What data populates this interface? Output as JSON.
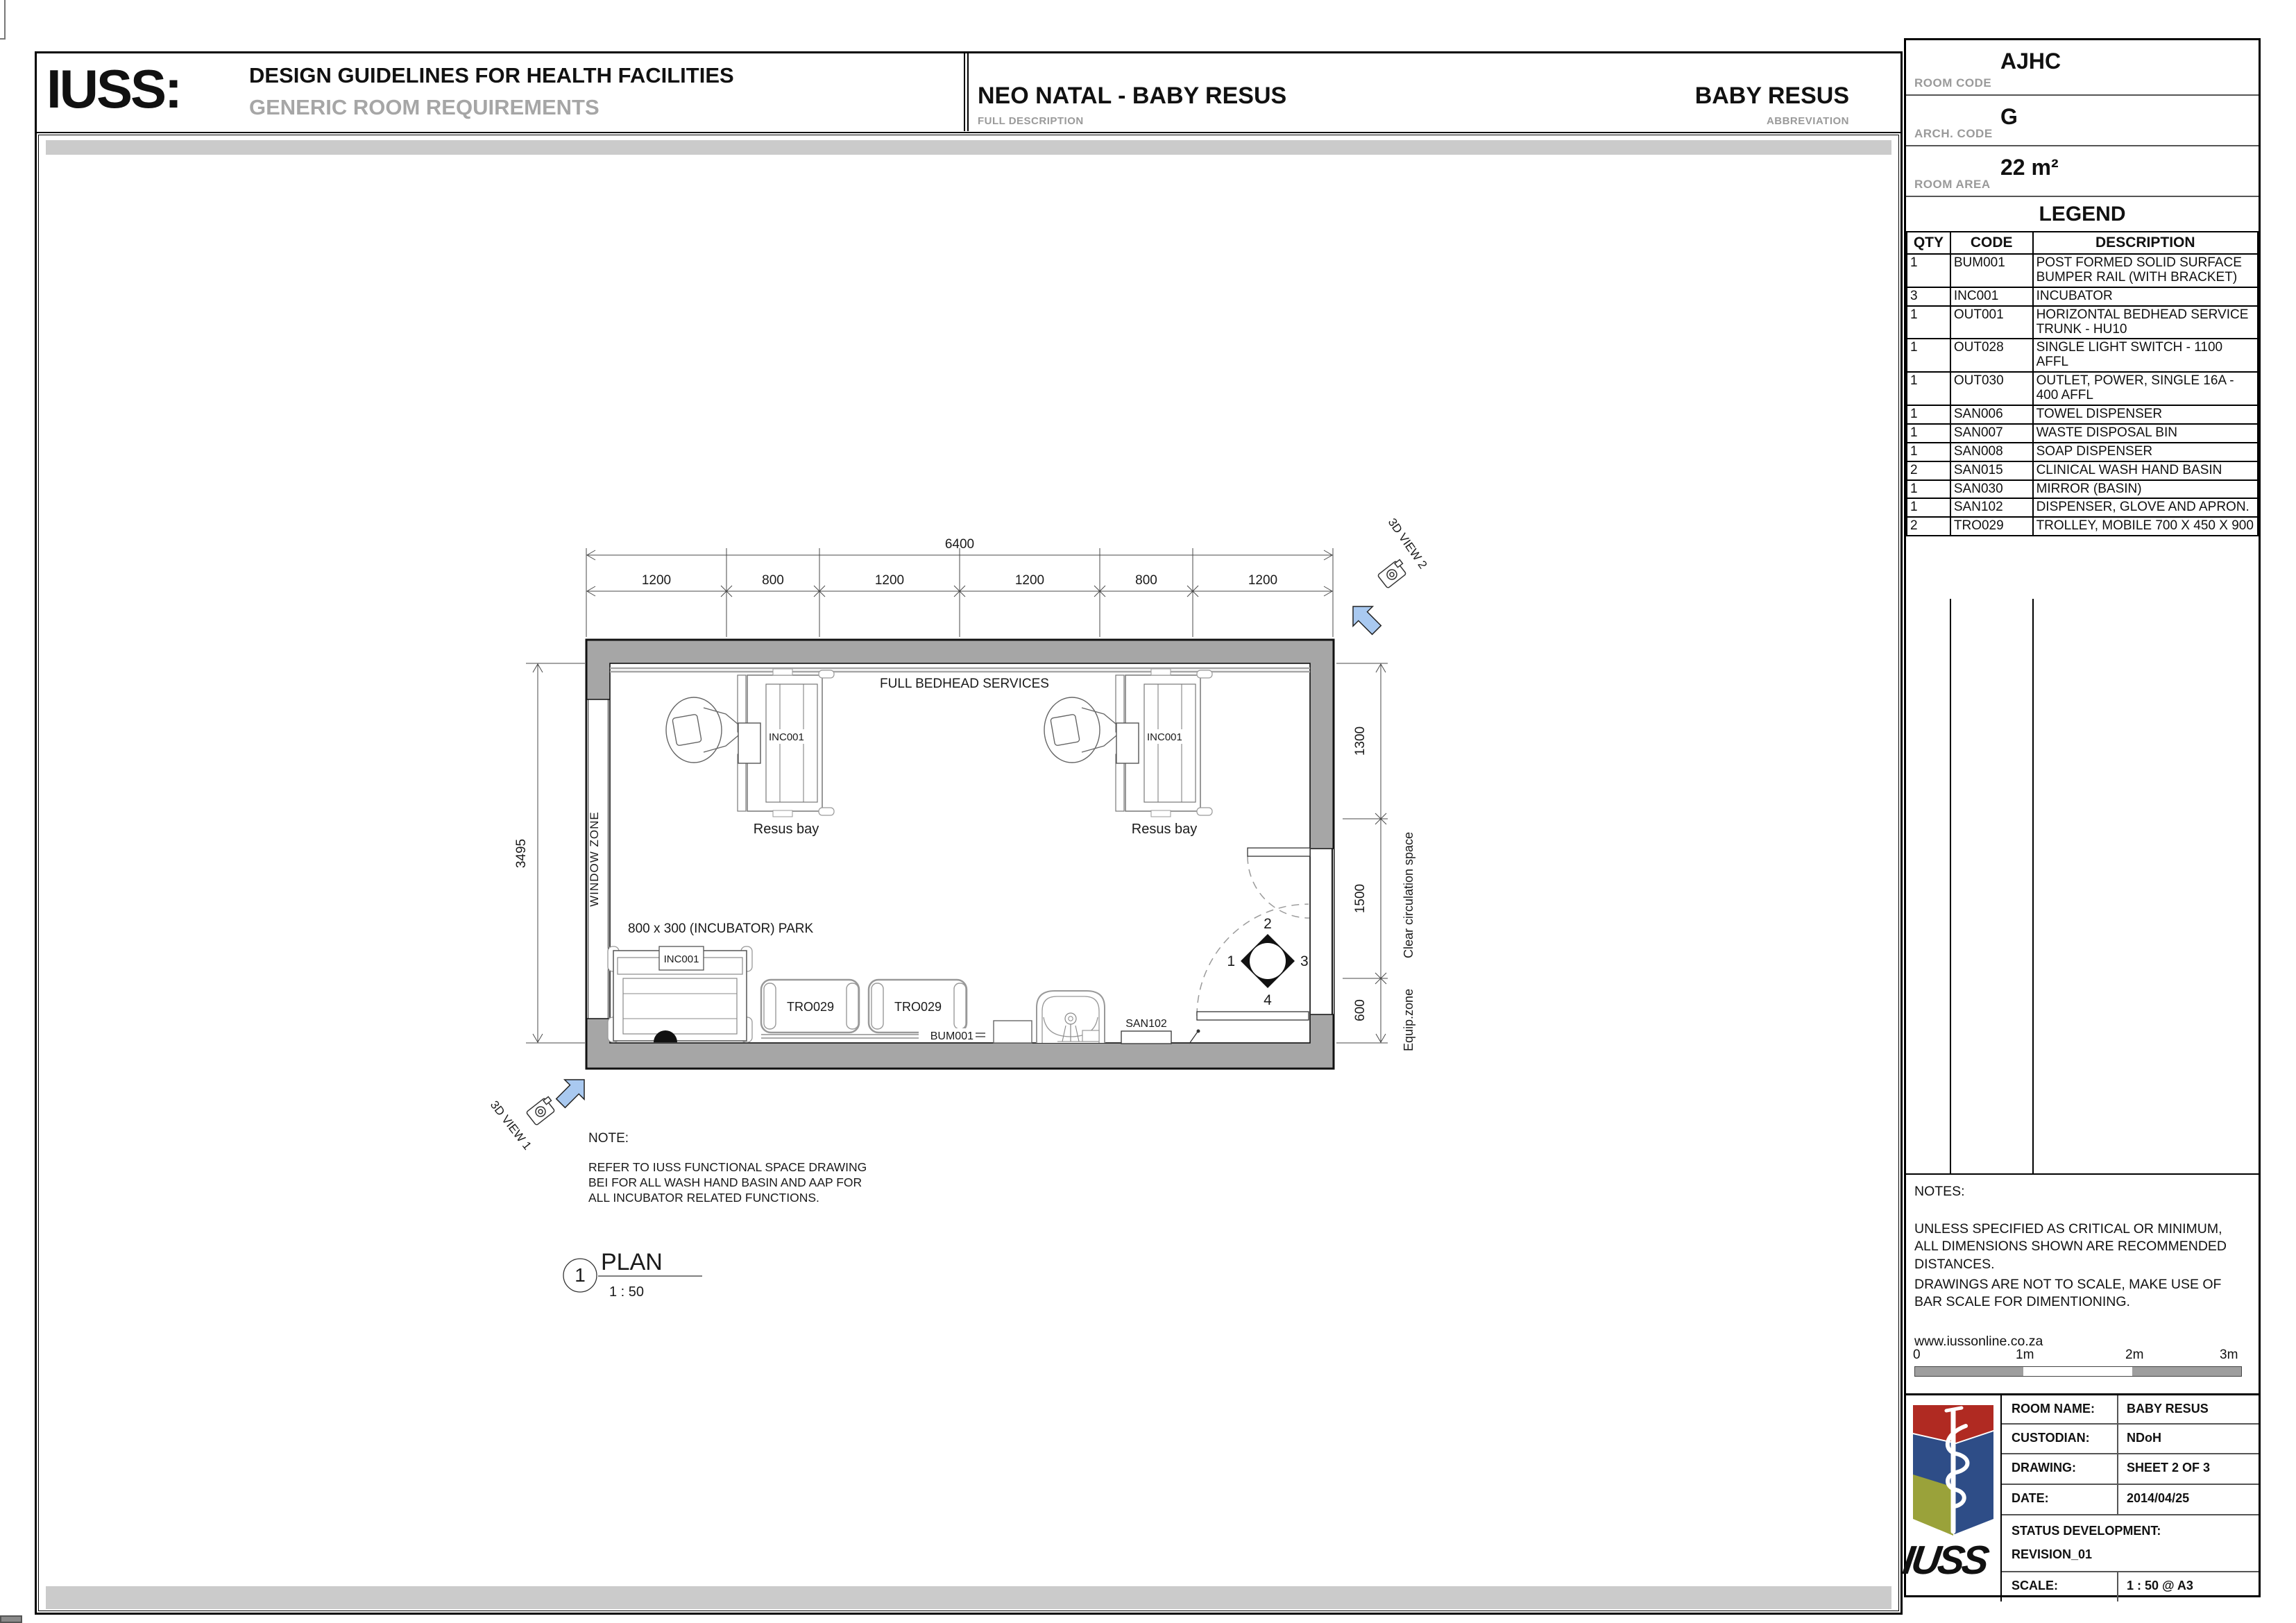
{
  "colors": {
    "wall_gray": "#a6a6a6",
    "band_gray": "#cbcbcb",
    "arrow_blue": "#a9c9f0",
    "logo_red": "#b02a22",
    "logo_blue": "#2e4d87",
    "logo_olive": "#9aa23a"
  },
  "header": {
    "brand": "IUSS:",
    "title": "DESIGN GUIDELINES FOR HEALTH FACILITIES",
    "subtitle": "GENERIC ROOM REQUIREMENTS",
    "full_description": "NEO NATAL  - BABY RESUS",
    "full_description_label": "FULL DESCRIPTION",
    "abbreviation": "BABY RESUS",
    "abbreviation_label": "ABBREVIATION"
  },
  "info": {
    "room_code_label": "ROOM CODE",
    "room_code": "AJHC",
    "arch_code_label": "ARCH. CODE",
    "arch_code": "G",
    "room_area_label": "ROOM AREA",
    "room_area": "22 m²"
  },
  "legend": {
    "title": "LEGEND",
    "col_qty": "QTY",
    "col_code": "CODE",
    "col_desc": "DESCRIPTION",
    "rows": [
      {
        "qty": "1",
        "code": "BUM001",
        "desc": "POST FORMED SOLID SURFACE BUMPER RAIL (WITH BRACKET)"
      },
      {
        "qty": "3",
        "code": "INC001",
        "desc": "INCUBATOR"
      },
      {
        "qty": "1",
        "code": "OUT001",
        "desc": "HORIZONTAL BEDHEAD SERVICE TRUNK - HU10"
      },
      {
        "qty": "1",
        "code": "OUT028",
        "desc": "SINGLE LIGHT SWITCH - 1100 AFFL"
      },
      {
        "qty": "1",
        "code": "OUT030",
        "desc": "OUTLET, POWER, SINGLE 16A - 400 AFFL"
      },
      {
        "qty": "1",
        "code": "SAN006",
        "desc": "TOWEL DISPENSER"
      },
      {
        "qty": "1",
        "code": "SAN007",
        "desc": "WASTE DISPOSAL BIN"
      },
      {
        "qty": "1",
        "code": "SAN008",
        "desc": "SOAP DISPENSER"
      },
      {
        "qty": "2",
        "code": "SAN015",
        "desc": "CLINICAL WASH HAND BASIN"
      },
      {
        "qty": "1",
        "code": "SAN030",
        "desc": "MIRROR (BASIN)"
      },
      {
        "qty": "1",
        "code": "SAN102",
        "desc": "DISPENSER, GLOVE AND APRON."
      },
      {
        "qty": "2",
        "code": "TRO029",
        "desc": "TROLLEY, MOBILE 700 X 450 X 900"
      }
    ]
  },
  "notes_panel": {
    "title": "NOTES:",
    "para1": "UNLESS SPECIFIED AS CRITICAL OR MINIMUM, ALL DIMENSIONS SHOWN ARE RECOMMENDED DISTANCES.",
    "para2": "DRAWINGS ARE NOT TO SCALE, MAKE USE OF BAR SCALE FOR DIMENTIONING.",
    "website": "www.iussonline.co.za",
    "scale_ticks": [
      "0",
      "1m",
      "2m",
      "3m"
    ]
  },
  "titleblock": {
    "logo_text": "IUSS",
    "room_name_label": "ROOM NAME:",
    "room_name": "BABY RESUS",
    "custodian_label": "CUSTODIAN:",
    "custodian": "NDoH",
    "drawing_label": "DRAWING:",
    "drawing": "SHEET 2 OF 3",
    "date_label": "DATE:",
    "date": "2014/04/25",
    "status_label": "STATUS DEVELOPMENT:",
    "status_value": "REVISION_01",
    "scale_label": "SCALE:",
    "scale_value": "1 : 50 @ A3"
  },
  "plan": {
    "dims": {
      "total_width": "6400",
      "top_segments": [
        "1200",
        "800",
        "1200",
        "1200",
        "800",
        "1200"
      ],
      "left_height": "3495",
      "right_segments": [
        "1300",
        "1500",
        "600"
      ]
    },
    "labels": {
      "full_bedhead": "FULL BEDHEAD SERVICES",
      "resus_bay": "Resus  bay",
      "window_zone": "WINDOW ZONE",
      "incubator_park": "800 x 300 (INCUBATOR) PARK",
      "inc001": "INC001",
      "tro029": "TRO029",
      "bum001": "BUM001",
      "san102": "SAN102",
      "clear_circulation": "Clear circulation space",
      "equip_zone": "Equip.zone",
      "view1": "3D VIEW 1",
      "view2": "3D VIEW 2"
    },
    "marker": {
      "n1": "1",
      "n2": "2",
      "n3": "3",
      "n4": "4"
    },
    "note": {
      "title": "NOTE:",
      "line1": "REFER TO IUSS FUNCTIONAL SPACE DRAWING",
      "line2": "BEI FOR ALL WASH HAND BASIN AND AAP FOR",
      "line3": "ALL INCUBATOR RELATED FUNCTIONS."
    },
    "title": {
      "number": "1",
      "name": "PLAN",
      "scale": "1 : 50"
    }
  }
}
